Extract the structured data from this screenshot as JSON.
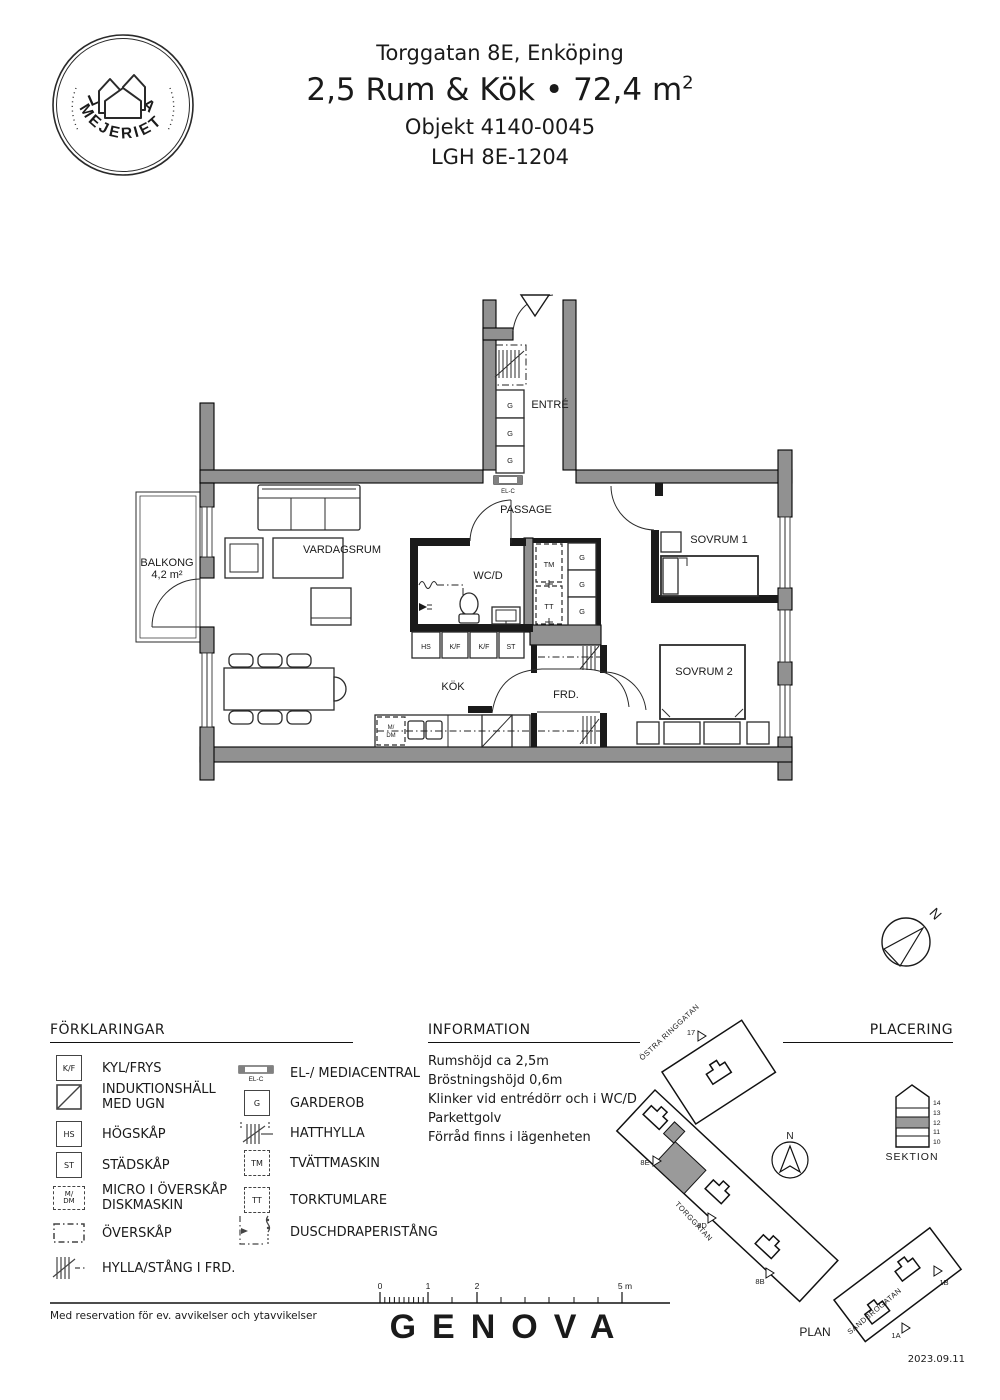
{
  "header": {
    "logo_top": "LILLA",
    "logo_bottom": "MEJERIET",
    "address": "Torggatan 8E, Enköping",
    "title": "2,5 Rum & Kök • 72,4 m",
    "title_sup": "2",
    "objekt": "Objekt 4140-0045",
    "lgh": "LGH 8E-1204"
  },
  "floorplan": {
    "rooms": {
      "entre": "ENTRÉ",
      "passage": "PASSAGE",
      "vardagsrum": "VARDAGSRUM",
      "wcd": "WC/D",
      "kok": "KÖK",
      "frd": "FRD.",
      "sovrum1": "SOVRUM 1",
      "sovrum2": "SOVRUM 2",
      "balkong": "BALKONG",
      "balkong_area": "4,2 m²"
    },
    "markers": {
      "g": "G",
      "tm": "TM",
      "tt": "TT",
      "elc": "EL-C",
      "hs": "HS",
      "kf": "K/F",
      "st": "ST",
      "m": "M/",
      "dm": "DM"
    },
    "north": "N"
  },
  "legend": {
    "title": "FÖRKLARINGAR",
    "left": [
      {
        "sym": "K/F",
        "label": "KYL/FRYS"
      },
      {
        "sym": "",
        "label": "INDUKTIONSHÄLL",
        "label2": "MED UGN"
      },
      {
        "sym": "HS",
        "label": "HÖGSKÅP"
      },
      {
        "sym": "ST",
        "label": "STÄDSKÅP"
      },
      {
        "sym": "M/",
        "sym2": "DM",
        "label": "MICRO I ÖVERSKÅP",
        "label2": "DISKMASKIN"
      },
      {
        "sym": "",
        "label": "ÖVERSKÅP"
      },
      {
        "sym": "",
        "label": "HYLLA/STÅNG I FRD."
      }
    ],
    "right": [
      {
        "sym": "EL-C",
        "label": "EL-/ MEDIACENTRAL"
      },
      {
        "sym": "G",
        "label": "GARDEROB"
      },
      {
        "sym": "",
        "label": "HATTHYLLA"
      },
      {
        "sym": "TM",
        "label": "TVÄTTMASKIN"
      },
      {
        "sym": "TT",
        "label": "TORKTUMLARE"
      },
      {
        "sym": "",
        "label": "DUSCHDRAPERISTÅNG"
      }
    ]
  },
  "information": {
    "title": "INFORMATION",
    "lines": [
      "Rumshöjd ca 2,5m",
      "Bröstningshöjd 0,6m",
      "Klinker vid entrédörr och i WC/D",
      "Parkettgolv",
      "Förråd finns i lägenheten"
    ]
  },
  "placering": {
    "title": "PLACERING",
    "streets": {
      "ostra": "ÖSTRA RINGGATAN",
      "torggatan": "TORGGATAN",
      "sandbrogatan": "SANDBROGATAN"
    },
    "entrances": {
      "e17": "17",
      "e8e": "8E",
      "e8d": "8D",
      "e8b": "8B",
      "e1a": "1A",
      "e1b": "1B"
    },
    "plan": "PLAN",
    "north": "N"
  },
  "sektion": {
    "title": "SEKTION",
    "floors": [
      "14",
      "13",
      "12",
      "11",
      "10"
    ]
  },
  "scalebar": {
    "l0": "0",
    "l1": "1",
    "l2": "2",
    "l5": "5 m"
  },
  "footer": {
    "disclaimer": "Med reservation för ev. avvikelser och ytavvikelser",
    "brand": "GENOVA",
    "date": "2023.09.11"
  },
  "colors": {
    "wall_gray": "#919191",
    "line": "#1a1a1a",
    "unit_highlight": "#9a9a9a"
  }
}
